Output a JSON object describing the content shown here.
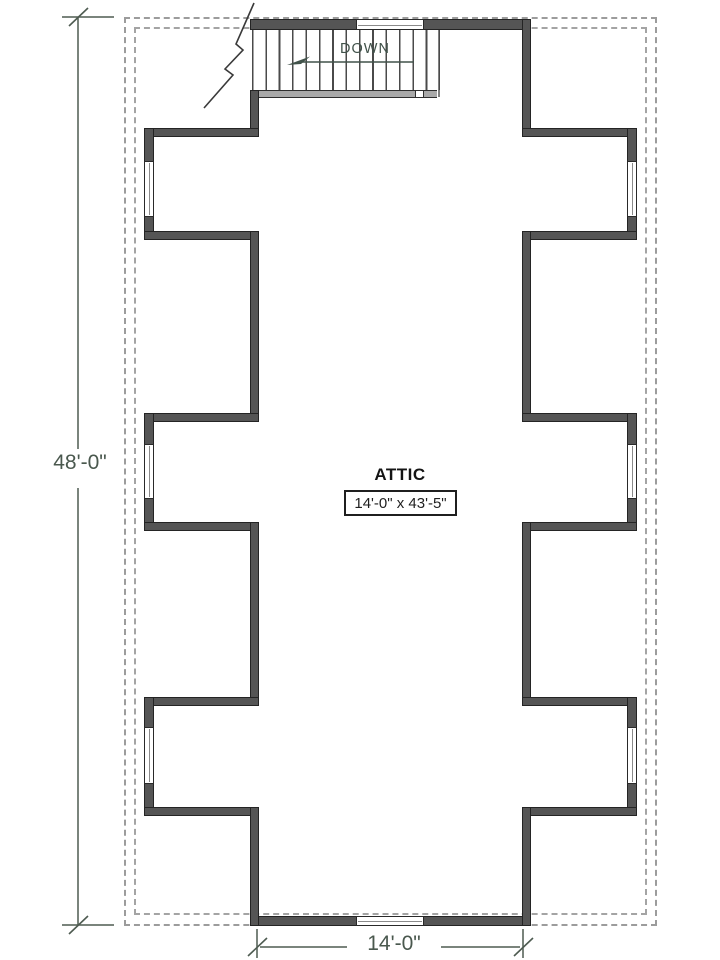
{
  "plan": {
    "type": "attic floor plan",
    "room": {
      "name": "ATTIC",
      "size": "14'-0\" x 43'-5\""
    },
    "stairs": {
      "label": "DOWN",
      "direction": "left"
    },
    "dimensions": {
      "left_overall": "48'-0\"",
      "bottom_width": "14'-0\""
    },
    "features": {
      "dormer_bays_per_side": 3,
      "windows": [
        "top-wall-window",
        "bottom-wall-window",
        "left-bay-1",
        "left-bay-2",
        "left-bay-3",
        "right-bay-1",
        "right-bay-2",
        "right-bay-3"
      ]
    },
    "colors": {
      "wall": "#555555",
      "wall_edge": "#242424",
      "annotation_green": "#41524a",
      "dimension_text": "#4a584e",
      "roof_dash": "#9c9c9c",
      "background": "#ffffff"
    }
  }
}
